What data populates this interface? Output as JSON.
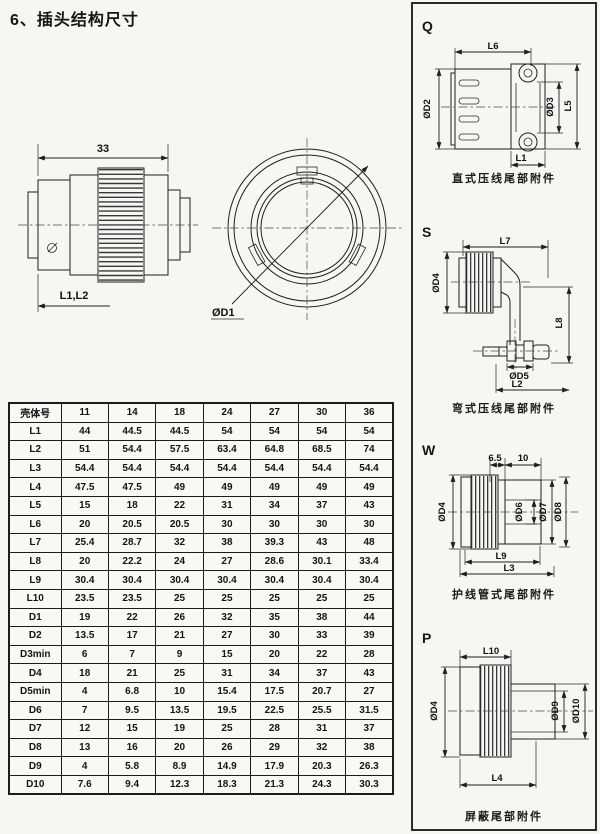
{
  "page": {
    "title": "6、插头结构尺寸"
  },
  "overview": {
    "side_view": {
      "dim_width": "33",
      "dim_length": "L1,L2"
    },
    "front_view": {
      "dim_diameter": "ØD1"
    }
  },
  "sections": {
    "q": {
      "letter": "Q",
      "caption": "直式压线尾部附件",
      "dims": {
        "l6": "L6",
        "d2": "ØD2",
        "d3": "ØD3",
        "l5": "L5",
        "l1": "L1"
      }
    },
    "s": {
      "letter": "S",
      "caption": "弯式压线尾部附件",
      "dims": {
        "l7": "L7",
        "d4": "ØD4",
        "l8": "L8",
        "d5": "ØD5",
        "l2": "L2"
      }
    },
    "w": {
      "letter": "W",
      "caption": "护线管式尾部附件",
      "dims": {
        "seg1": "6.5",
        "seg2": "10",
        "d4": "ØD4",
        "d6": "ØD6",
        "d7": "ØD7",
        "d8": "ØD8",
        "l9": "L9",
        "l3": "L3"
      }
    },
    "p": {
      "letter": "P",
      "caption": "屏蔽尾部附件",
      "dims": {
        "l10": "L10",
        "d4": "ØD4",
        "d9": "ØD9",
        "d10": "ØD10",
        "l4": "L4"
      }
    }
  },
  "table": {
    "header": [
      "壳体号",
      "11",
      "14",
      "18",
      "24",
      "27",
      "30",
      "36"
    ],
    "rows": [
      [
        "L1",
        "44",
        "44.5",
        "44.5",
        "54",
        "54",
        "54",
        "54"
      ],
      [
        "L2",
        "51",
        "54.4",
        "57.5",
        "63.4",
        "64.8",
        "68.5",
        "74"
      ],
      [
        "L3",
        "54.4",
        "54.4",
        "54.4",
        "54.4",
        "54.4",
        "54.4",
        "54.4"
      ],
      [
        "L4",
        "47.5",
        "47.5",
        "49",
        "49",
        "49",
        "49",
        "49"
      ],
      [
        "L5",
        "15",
        "18",
        "22",
        "31",
        "34",
        "37",
        "43"
      ],
      [
        "L6",
        "20",
        "20.5",
        "20.5",
        "30",
        "30",
        "30",
        "30"
      ],
      [
        "L7",
        "25.4",
        "28.7",
        "32",
        "38",
        "39.3",
        "43",
        "48"
      ],
      [
        "L8",
        "20",
        "22.2",
        "24",
        "27",
        "28.6",
        "30.1",
        "33.4"
      ],
      [
        "L9",
        "30.4",
        "30.4",
        "30.4",
        "30.4",
        "30.4",
        "30.4",
        "30.4"
      ],
      [
        "L10",
        "23.5",
        "23.5",
        "25",
        "25",
        "25",
        "25",
        "25"
      ],
      [
        "D1",
        "19",
        "22",
        "26",
        "32",
        "35",
        "38",
        "44"
      ],
      [
        "D2",
        "13.5",
        "17",
        "21",
        "27",
        "30",
        "33",
        "39"
      ],
      [
        "D3min",
        "6",
        "7",
        "9",
        "15",
        "20",
        "22",
        "28"
      ],
      [
        "D4",
        "18",
        "21",
        "25",
        "31",
        "34",
        "37",
        "43"
      ],
      [
        "D5min",
        "4",
        "6.8",
        "10",
        "15.4",
        "17.5",
        "20.7",
        "27"
      ],
      [
        "D6",
        "7",
        "9.5",
        "13.5",
        "19.5",
        "22.5",
        "25.5",
        "31.5"
      ],
      [
        "D7",
        "12",
        "15",
        "19",
        "25",
        "28",
        "31",
        "37"
      ],
      [
        "D8",
        "13",
        "16",
        "20",
        "26",
        "29",
        "32",
        "38"
      ],
      [
        "D9",
        "4",
        "5.8",
        "8.9",
        "14.9",
        "17.9",
        "20.3",
        "26.3"
      ],
      [
        "D10",
        "7.6",
        "9.4",
        "12.3",
        "18.3",
        "21.3",
        "24.3",
        "30.3"
      ]
    ]
  }
}
